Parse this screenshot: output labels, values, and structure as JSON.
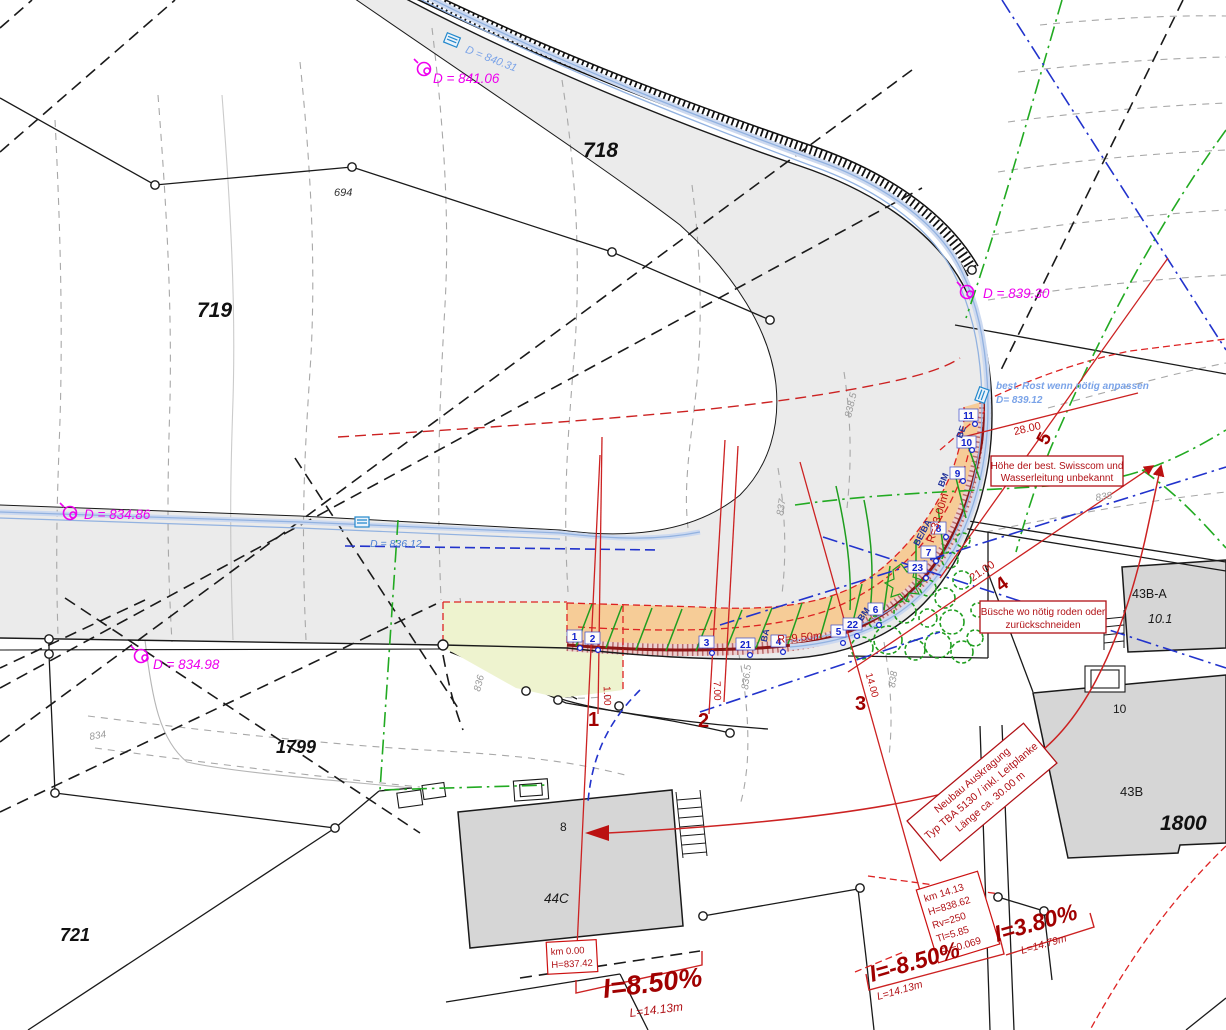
{
  "plan": {
    "parcels": {
      "p718": "718",
      "p719": "719",
      "p694": "694",
      "p1799": "1799",
      "p721": "721",
      "p1800": "1800"
    },
    "buildings": {
      "b44c": "44C",
      "b44c_no": "8",
      "b43b": "43B",
      "b43b_no": "10",
      "b43ba": "43B-A",
      "b43ba_no": "10.1"
    },
    "manholes": {
      "d841": "D = 841.06",
      "d83486": "D = 834.86",
      "d83498": "D = 834.98",
      "d83930": "D = 839.30"
    },
    "pipes": {
      "d84031": "D = 840.31",
      "d83612": "D = 836.12",
      "rost1": "best. Rost wenn nötig anpassen",
      "rost2": "D= 839.12"
    },
    "notes": {
      "swisscom1": "Höhe der best. Swisscom und",
      "swisscom2": "Wasserleitung unbekannt",
      "buesche1": "Büsche wo nötig roden oder",
      "buesche2": "zurückschneiden",
      "neubau1": "Neubau Auskragung",
      "neubau2": "Typ TBA 5130 / inkl. Leitplanke",
      "neubau3": "Länge ca. 30.00 m"
    },
    "km14": {
      "l1": "km 14.13",
      "l2": "H=838.62",
      "l3": "Rv=250",
      "l4": "Tl=5.85",
      "l5": "Fv=0.069"
    },
    "km0": {
      "l1": "km 0.00",
      "l2": "H=837.42"
    },
    "slopes": {
      "s1": "I=8.50%",
      "s1l": "L=14.13m",
      "s2": "I=-8.50%",
      "s2l": "L=14.13m",
      "s3": "I=3.80%",
      "s3l": "L=14.79m"
    },
    "dims": {
      "d28": "28.00",
      "d21": "21.00",
      "d14": "14.00",
      "d7": "7.00",
      "d1": "1.00",
      "r950": "R=9.50m",
      "r3300": "R=33.00m"
    },
    "sections": {
      "s1": "1",
      "s2": "2",
      "s3": "3",
      "s4": "4",
      "s5": "5"
    },
    "posts": [
      "1",
      "2",
      "3",
      "21",
      "4",
      "5",
      "22",
      "6",
      "23",
      "7",
      "8",
      "9",
      "10",
      "11"
    ],
    "marks": {
      "ba": "BA",
      "bm1": "BM",
      "beba": "BE/BA",
      "bm2": "BM",
      "be": "BE"
    },
    "contours": {
      "c834": "834",
      "c836": "836",
      "c8365": "836.5",
      "c838a": "838",
      "c837": "837",
      "c8385": "838.5",
      "c838b": "838"
    }
  }
}
